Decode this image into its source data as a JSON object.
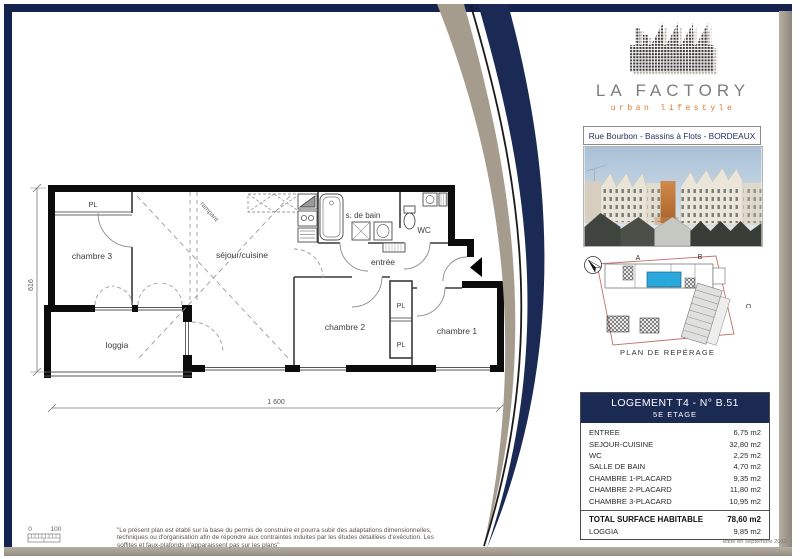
{
  "page": {
    "frame_color": "#15234e",
    "edge_color": "#a59c8e"
  },
  "logo": {
    "brand": "LA FACTORY",
    "tagline": "urban lifestyle",
    "icon": "factory-dot-matrix"
  },
  "address_banner": "Rue Bourbon - Bassins à Flots - BORDEAUX",
  "floor_plan": {
    "rooms": {
      "pl_top": "PL",
      "chambre3": "chambre 3",
      "sejour": "séjour/cuisine",
      "rampant": "rampant",
      "sdb": "s. de bain",
      "wc": "WC",
      "entree": "entrée",
      "chambre2": "chambre 2",
      "pl1": "PL",
      "pl2": "PL",
      "chambre1": "chambre 1",
      "loggia": "loggia"
    },
    "dimensions": {
      "width": "1 600",
      "height": "616"
    },
    "scale": {
      "start": "0",
      "end": "100"
    }
  },
  "site_plan": {
    "caption": "PLAN DE REPÉRAGE",
    "labels": [
      "A",
      "B",
      "C"
    ],
    "unit_color": "#2aa7dc",
    "outline_color": "#c4706a"
  },
  "unit_table": {
    "title": "LOGEMENT T4 - N° B.51",
    "subtitle": "5E ETAGE",
    "rows": [
      {
        "label": "ENTREE",
        "value": "6,75 m2"
      },
      {
        "label": "SEJOUR-CUISINE",
        "value": "32,80 m2"
      },
      {
        "label": "WC",
        "value": "2,25 m2"
      },
      {
        "label": "SALLE DE BAIN",
        "value": "4,70 m2"
      },
      {
        "label": "CHAMBRE 1-PLACARD",
        "value": "9,35 m2"
      },
      {
        "label": "CHAMBRE 2-PLACARD",
        "value": "11,80 m2"
      },
      {
        "label": "CHAMBRE 3-PLACARD",
        "value": "10,95 m2"
      }
    ],
    "total": {
      "label": "TOTAL SURFACE HABITABLE",
      "value": "78,60 m2"
    },
    "extra": {
      "label": "LOGGIA",
      "value": "9,85 m2"
    }
  },
  "footer": {
    "disclaimer": "\"Le présent plan est établi sur la base du permis de construire et pourra subir des adaptations dimensionnelles, techniques ou d'organisation afin de répondre aux contraintes induites par les études détaillées d'exécution. Les soffites et faux-plafonds n'apparaissent pas sur les plans\"",
    "edition": "édité en septembre 2012"
  }
}
